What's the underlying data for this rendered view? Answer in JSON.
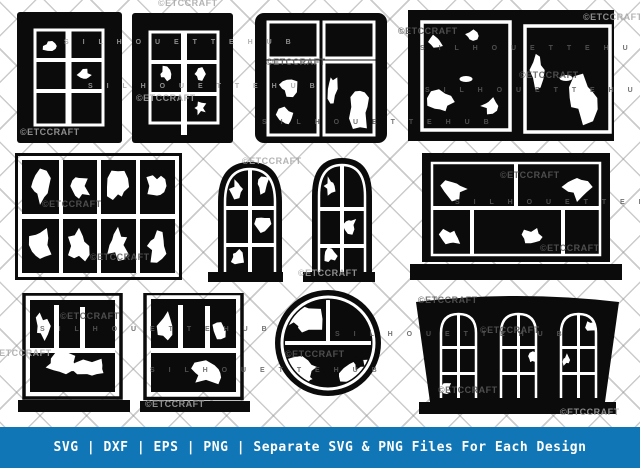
{
  "canvas": {
    "width": 640,
    "height": 468
  },
  "colors": {
    "background": "#ffffff",
    "silhouette": "#0b0b0b",
    "glass_hole": "#ffffff",
    "footer_bg": "#1176b5",
    "footer_text": "#ffffff",
    "lattice_line": "#8c8c8c",
    "watermark_on_white": "#a6a6a6",
    "watermark_on_black": "#5a5a5a"
  },
  "footer": {
    "text": "SVG | DXF | EPS | PNG | Separate SVG & PNG Files For Each Design"
  },
  "watermarks": {
    "brand": "©ETCCRAFT",
    "hub": "S I L H O U E T T E   H U B"
  },
  "designs": [
    {
      "name": "tall-window-2x3-grid-broken-a"
    },
    {
      "name": "tall-window-2x3-grid-broken-b"
    },
    {
      "name": "casement-window-2x2-rounded-broken"
    },
    {
      "name": "double-sash-window-with-handles-broken"
    },
    {
      "name": "wide-8-pane-window-shattered"
    },
    {
      "name": "arched-window-broken-a"
    },
    {
      "name": "arched-window-broken-b"
    },
    {
      "name": "wide-window-on-sill-broken"
    },
    {
      "name": "square-window-on-sill-shattered-a"
    },
    {
      "name": "square-window-on-sill-shattered-b"
    },
    {
      "name": "round-window-broken"
    },
    {
      "name": "bay-storefront-arched-windows-broken"
    }
  ]
}
